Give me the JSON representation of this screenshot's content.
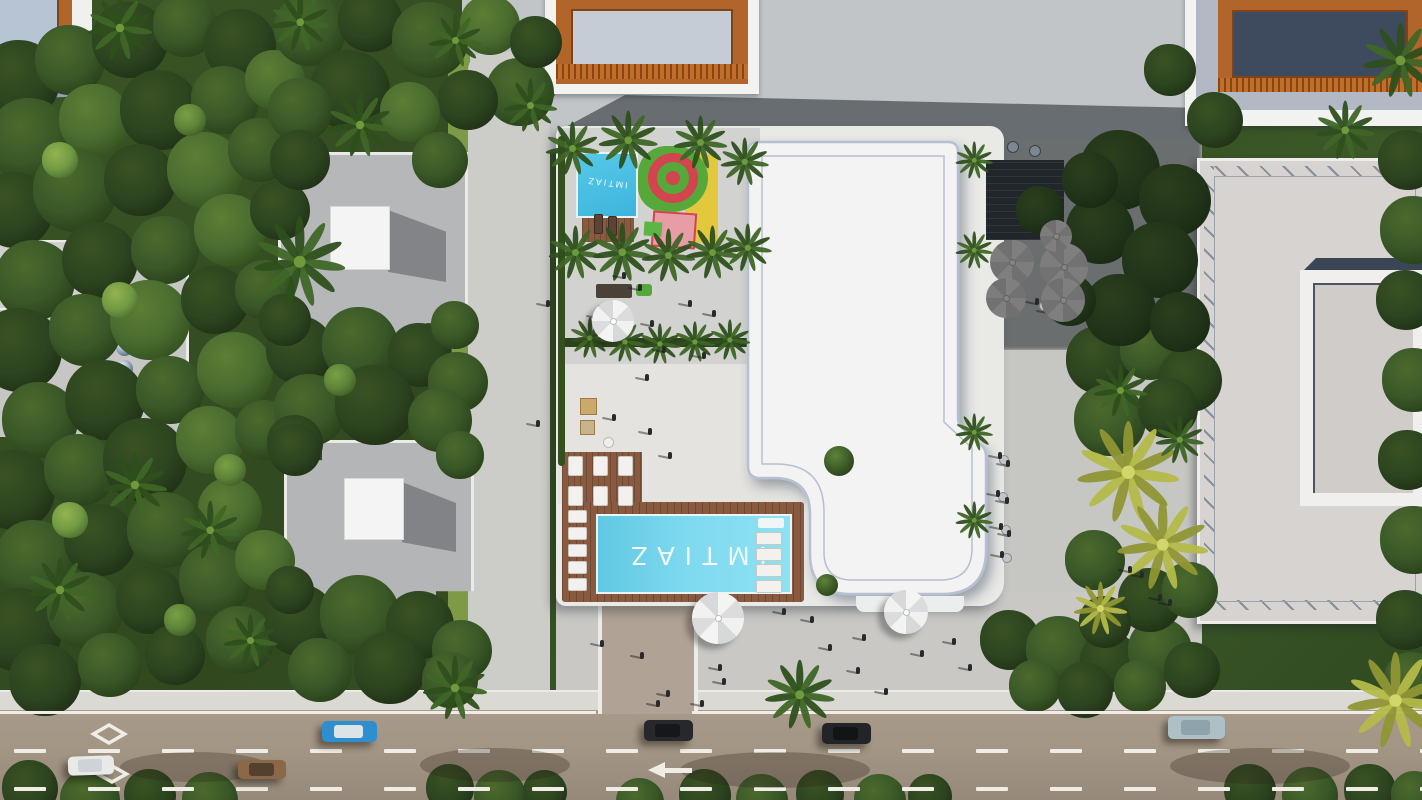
{
  "scene": {
    "type": "aerial-architectural-render",
    "description": "Top-down aerial render of the IMTIAZ residential development: main white building with rooftop amenities, branded swimming pool, kids aqua park with playground, landscaped plaza, cafe umbrellas, surrounding villas, dense greenery and a boulevard with traffic",
    "brand": {
      "pool_label": "IMTIAZ",
      "kids_pool_label": "IMTIAZ"
    },
    "road": {
      "direction_arrow": "left",
      "markings": [
        "dashed-lane-lines",
        "diamond-symbol",
        "left-arrow"
      ],
      "cars": [
        {
          "color": "white"
        },
        {
          "color": "bronze"
        },
        {
          "color": "blue-convertible"
        },
        {
          "color": "black"
        },
        {
          "color": "black"
        },
        {
          "color": "silver-blue"
        }
      ]
    },
    "amenities": [
      "main-pool",
      "kids-pool",
      "playground",
      "sun-loungers",
      "gazebo",
      "cafe-umbrellas",
      "pergola",
      "plaza"
    ],
    "palette": {
      "foliage_dark": "#22351a",
      "foliage_mid": "#3a5828",
      "foliage_light": "#5d8339",
      "palm_yellow": "#b5ba4a",
      "pavement": "#c9c8c5",
      "road": "#a39584",
      "sidewalk": "#dbd9d4",
      "roof_white": "#f4f3f4",
      "roof_grey": "#d6d3d0",
      "roof_tile_grey": "#b6b7b9",
      "roof_orange": "#b2652a",
      "pool_blue": "#74d4ec",
      "deck_wood": "#8a5a40",
      "playground_red": "#d2444e",
      "playground_green": "#57a83b",
      "playground_yellow": "#e3c83e",
      "playground_pink": "#e79ca6",
      "marking_white": "#efede6"
    }
  }
}
